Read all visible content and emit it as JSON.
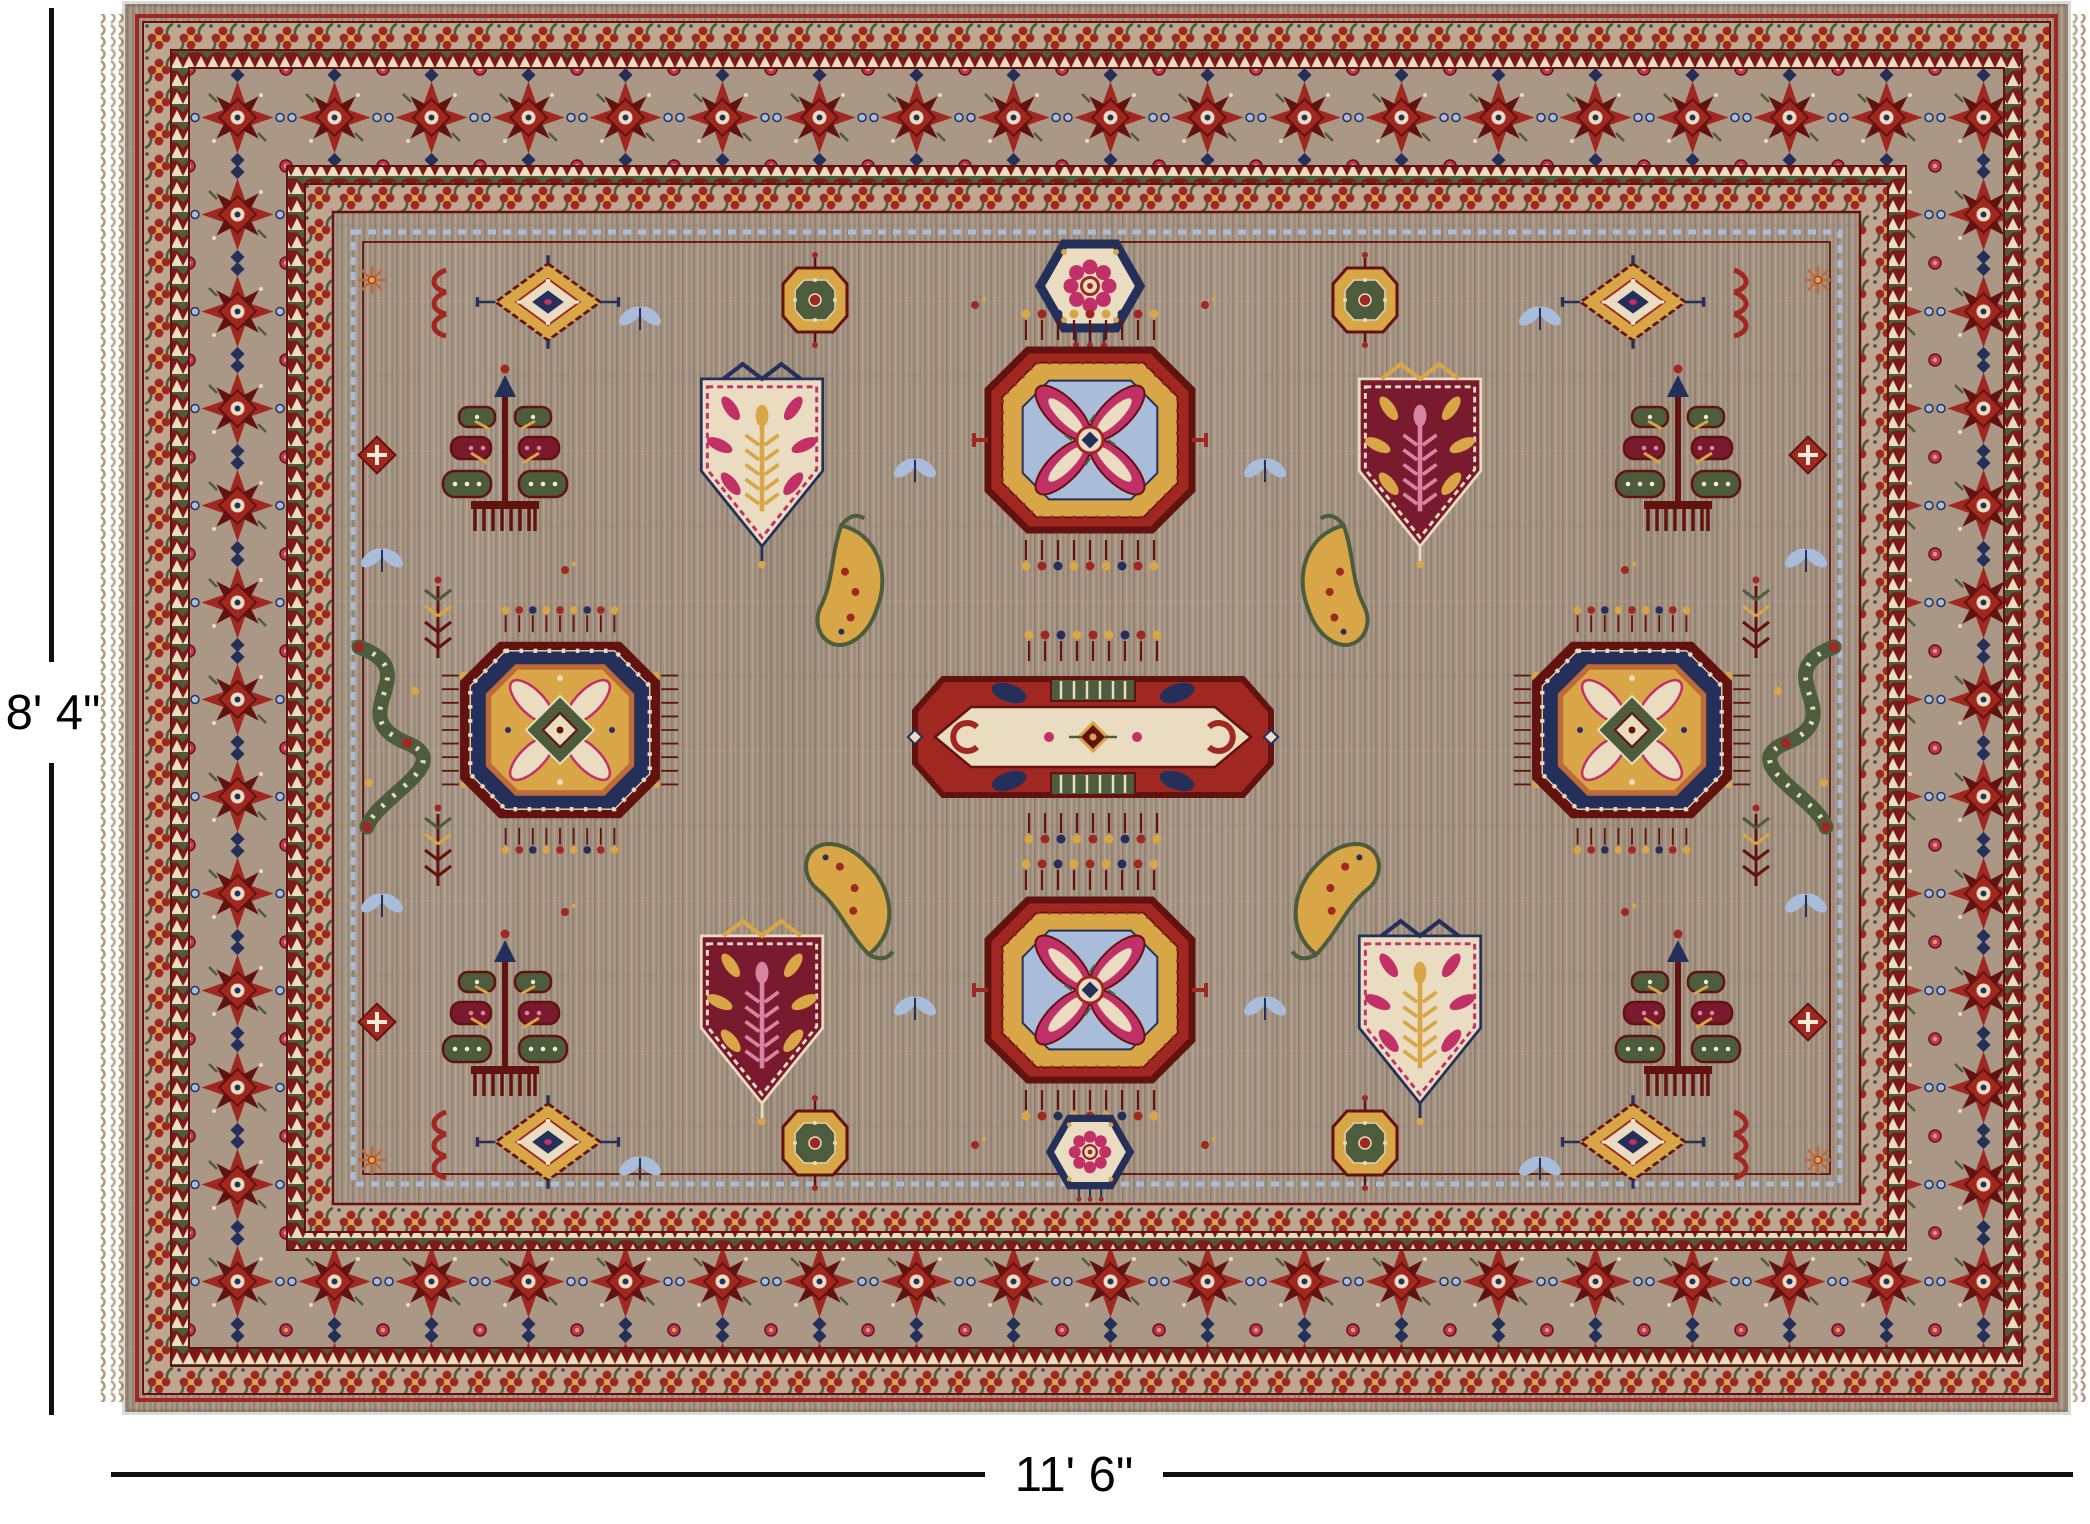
{
  "page": {
    "background": "#ffffff"
  },
  "annotations": {
    "height_label": "8' 4\"",
    "width_label": "11' 6\"",
    "line_color": "#0f0f0f",
    "label_color": "#000000"
  },
  "rug": {
    "palette": {
      "taupe": "#a39181",
      "taupe_dark": "#8d7c6c",
      "taupe_light": "#b9a794",
      "tan_guard": "#bfa78f",
      "band_red": "#7d1a16",
      "red": "#a02820",
      "maroon": "#63130f",
      "cream": "#e9dcc0",
      "gold": "#d9a647",
      "navy": "#25305a",
      "blue": "#a9bdda",
      "green": "#4c5c3c",
      "magenta": "#c13066",
      "pink": "#d783a2",
      "orange": "#c06a38",
      "wine": "#7a1a2e",
      "white": "#f3ecd9",
      "fringe": "#c3ad92",
      "fringe_dark": "#b29a7e",
      "line": "#0f0f0f",
      "label": "#000000"
    }
  }
}
